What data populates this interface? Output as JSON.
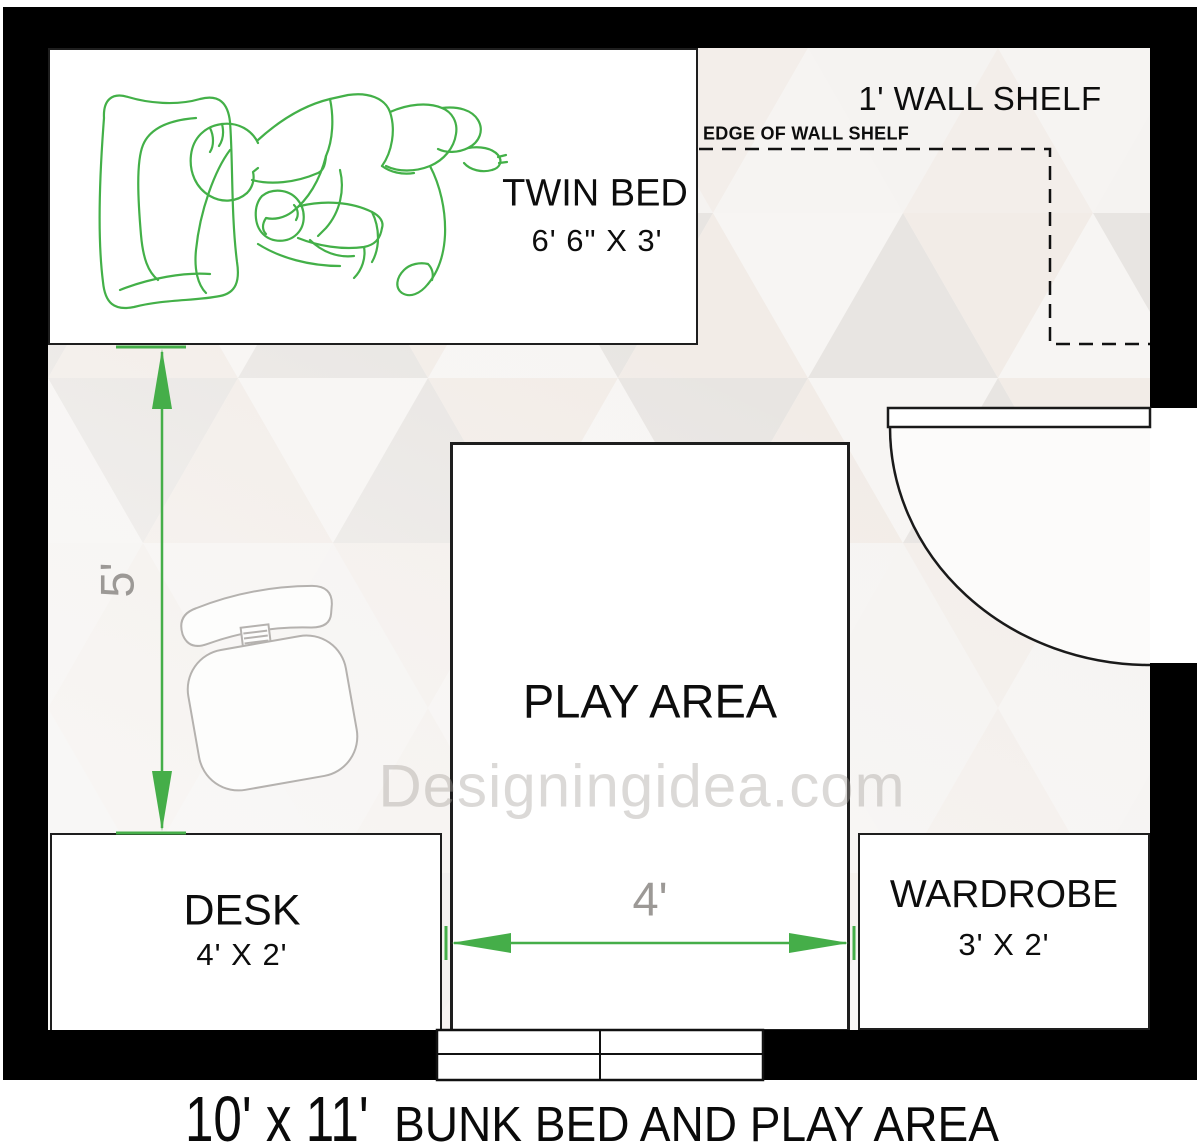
{
  "plan": {
    "title_dimensions": "10' x 11'",
    "title_text": "BUNK BED AND PLAY AREA",
    "watermark": "Designingidea.com",
    "twin_bed": {
      "label": "TWIN BED",
      "size": "6' 6\" X 3'"
    },
    "wall_shelf": {
      "label": "1' WALL SHELF",
      "edge_label": "EDGE OF WALL SHELF"
    },
    "play_area": {
      "label": "PLAY AREA"
    },
    "desk": {
      "label": "DESK",
      "size": "4' X 2'"
    },
    "wardrobe": {
      "label": "WARDROBE",
      "size": "3' X 2'"
    },
    "dimensions": {
      "left_height": "5'",
      "play_width": "4'"
    },
    "colors": {
      "wall_black": "#000000",
      "dimension_green": "#45ae49",
      "sketch_green": "#43b048",
      "dim_label_gray": "#9c9996",
      "chair_gray": "#b5b2af"
    }
  }
}
